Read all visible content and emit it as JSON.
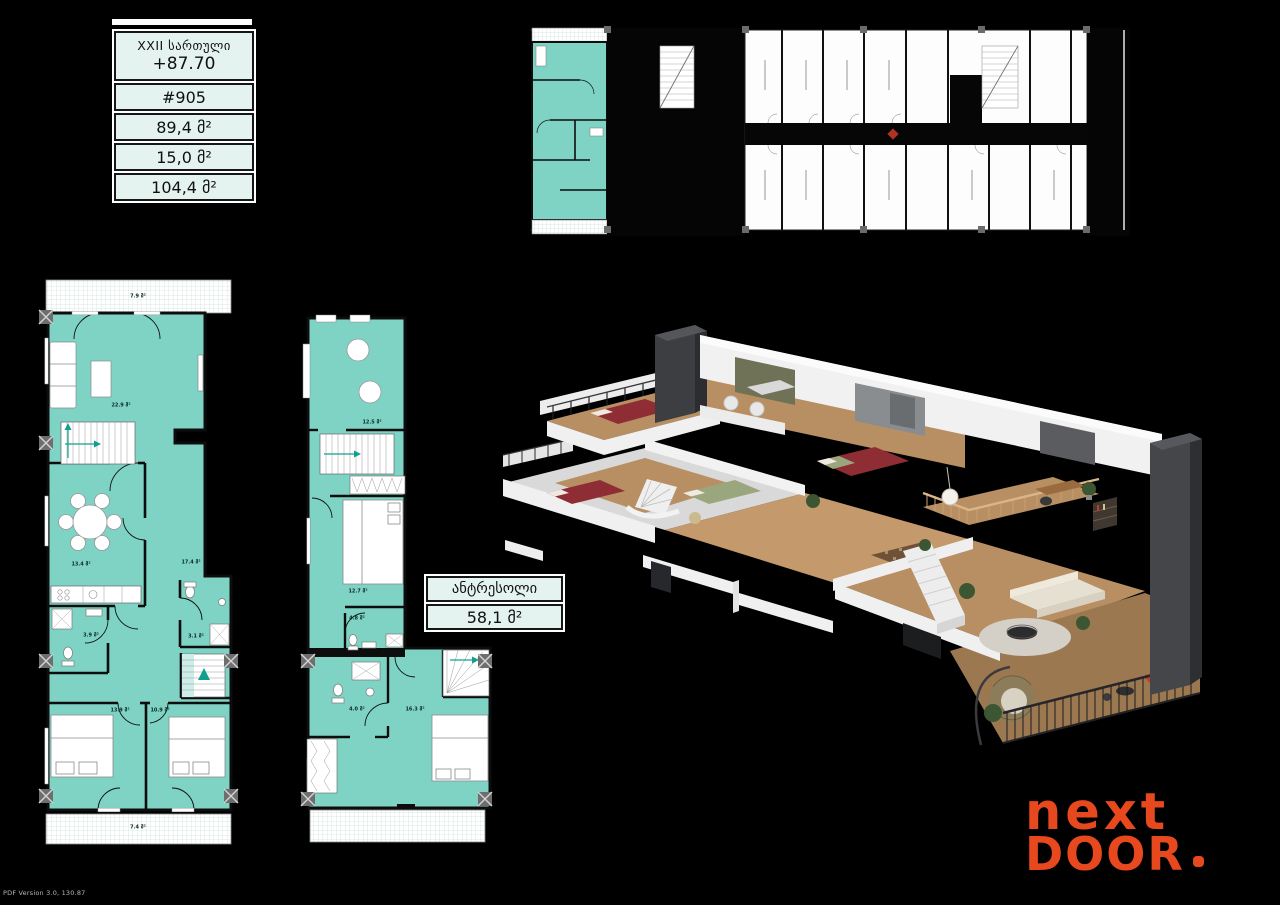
{
  "colors": {
    "background": "#000000",
    "highlight_teal": "#7ED3C5",
    "table_mint": "#E4F3EF",
    "logo_orange": "#E8481E",
    "marker_red": "#B03226",
    "wood": "#B78F63"
  },
  "info_table": {
    "floor_label": "XXII სართული",
    "elevation": "+87.70",
    "unit_number": "#905",
    "area_living": "89,4 მ²",
    "area_summer": "15,0 მ²",
    "area_total": "104,4 მ²"
  },
  "main_plan": {
    "rooms": [
      {
        "name": "balcony-top",
        "area": "7.9 მ²"
      },
      {
        "name": "living-room",
        "area": "22.9 მ²"
      },
      {
        "name": "dining-kitchen",
        "area": "13.4 მ²"
      },
      {
        "name": "hall",
        "area": "17.4 მ²"
      },
      {
        "name": "bathroom-1",
        "area": "3.9 მ²"
      },
      {
        "name": "bathroom-2",
        "area": "3.1 მ²"
      },
      {
        "name": "bedroom-1",
        "area": "13.9 მ²"
      },
      {
        "name": "bedroom-2",
        "area": "10.9 მ²"
      },
      {
        "name": "balcony-bottom",
        "area": "7.4 მ²"
      }
    ]
  },
  "mezzanine": {
    "label": "ანტრესოლი",
    "area": "58,1 მ²",
    "rooms": [
      {
        "name": "bathroom-top",
        "area": "12.5 მ²"
      },
      {
        "name": "bedroom-1",
        "area": "12.7 მ²"
      },
      {
        "name": "bathroom-1",
        "area": "4.8 მ²"
      },
      {
        "name": "bathroom-2",
        "area": "4.0 მ²"
      },
      {
        "name": "bedroom-2",
        "area": "16.3 მ²"
      }
    ]
  },
  "logo": {
    "line1": "next",
    "line2": "DOOR",
    "dot": "."
  },
  "watermark": {
    "text": "PDF Version 3.0, 130.87"
  }
}
